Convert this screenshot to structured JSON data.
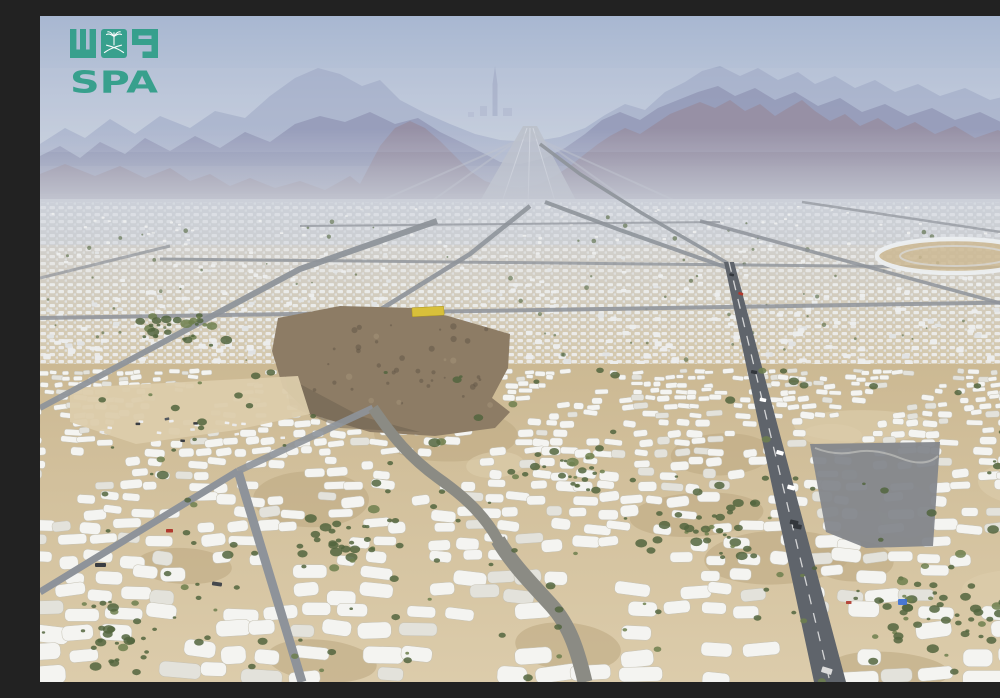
{
  "meta": {
    "type": "aerial-photograph",
    "description": "High-angle aerial photo of the Mina pilgrim tent city: thousands of white tents in blocks on tan desert ground, a road network converging on a multi-lane highway corridor that runs to a hazy mountain horizon, a rocky brown outcrop, parking areas, scattered green trees and a circular interchange at right."
  },
  "watermark": {
    "agency_latin": "SPA",
    "agency_arabic": "واس",
    "color": "#2f9e88",
    "emblem": "palm-tree-and-crossed-swords"
  },
  "photo": {
    "palette": {
      "sky_top": "#a8b7d1",
      "sky_horizon": "#c9d1de",
      "sky_low": "#d3d8e2",
      "haze": "#c6cddd",
      "mountain_far": "#96a0c0",
      "mountain_mid": "#8589ab",
      "mountain_near": "#8e8295",
      "horizon_fill": "#c5c9d3",
      "valley_road": "#b9bdc5",
      "mid_base_top": "#cfd2d8",
      "mid_base_bottom": "#d5c8ab",
      "block_white": "#edeeee",
      "block_gray": "#e2e4e5",
      "ground_tan": "#ccb993",
      "ground_tan_light": "#dcccab",
      "ground_tan_dark": "#c0ac85",
      "tent_white": "#f4f4f1",
      "tent_shade": "#e3e2db",
      "tent_edge": "#c6c2b4",
      "road_dark": "#5f646b",
      "road_mid": "#8e939a",
      "road_camp": "#8b8b84",
      "road_light": "#dfe2e8",
      "hill_brown": "#8d7c65",
      "hill_dark": "#6c604f",
      "rock_speck": "#5f5346",
      "lot_gray": "#84878c",
      "tree_green": "#52653e",
      "tree_light": "#6d7f4e",
      "accent_yellow": "#d8c03a",
      "accent_blue": "#3a6fd8",
      "accent_red": "#b0392e",
      "tower_silhouette": "#8d94b5",
      "logo": "#2f9e88"
    },
    "landmarks": {
      "clock_tower": "clock-tower silhouette on hazy horizon",
      "highway": "multi-lane highway corridor converging to horizon",
      "ring": "circular interchange structure at right",
      "hill": "rocky brown outcrop at center-left",
      "tents": "white pilgrim tent blocks",
      "parking": "tan parking apron with vehicles",
      "paved_lot": "dark paved lot at right"
    }
  },
  "procedural": {
    "seed": 20240615,
    "tent_skip": 0.2,
    "tree_count": 150,
    "mid_block_count": 380,
    "clearing_count": 18,
    "car_count": 16
  }
}
